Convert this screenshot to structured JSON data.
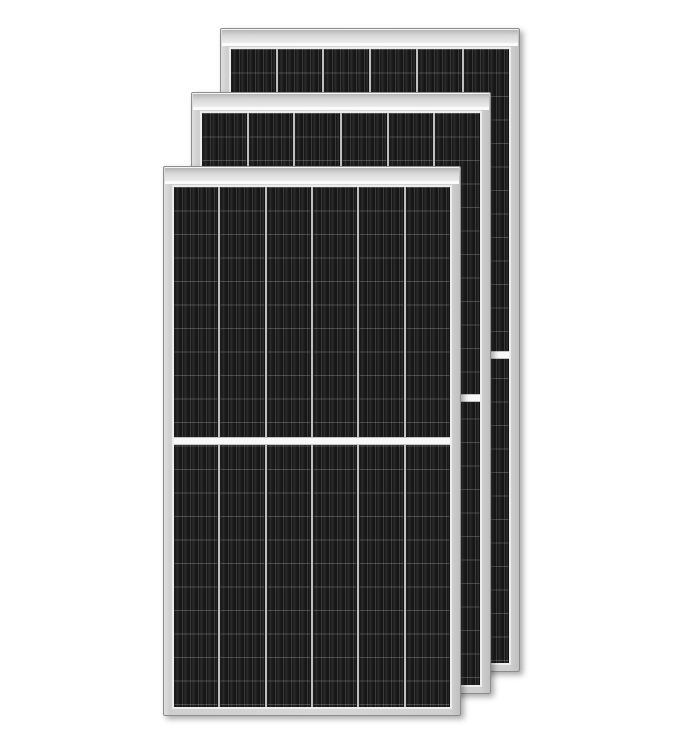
{
  "image": {
    "description": "Product photo of three overlapping black monocrystalline half-cut solar panels with silver aluminium frames on a white background",
    "text_content": "none"
  },
  "colors": {
    "background": "#ffffff",
    "frame": "#cfcfcf",
    "frame_edge": "#8d8d8d",
    "cell_dark": "#161616",
    "cell_stripe": "#3a3a3a",
    "column_gap": "#bfbfbf",
    "cells_border": "#ededed",
    "divider_white": "#f8f8f8"
  },
  "panels": [
    {
      "id": "back",
      "x": 220,
      "y": 28,
      "width": 300,
      "height": 644,
      "z": 1,
      "columns": 6,
      "divider_percent": 49.9
    },
    {
      "id": "middle",
      "x": 191,
      "y": 92,
      "width": 300,
      "height": 602,
      "z": 2,
      "columns": 6,
      "divider_percent": 49.8
    },
    {
      "id": "front",
      "x": 163,
      "y": 166,
      "width": 298,
      "height": 550,
      "z": 3,
      "columns": 6,
      "divider_percent": 48.9
    }
  ]
}
